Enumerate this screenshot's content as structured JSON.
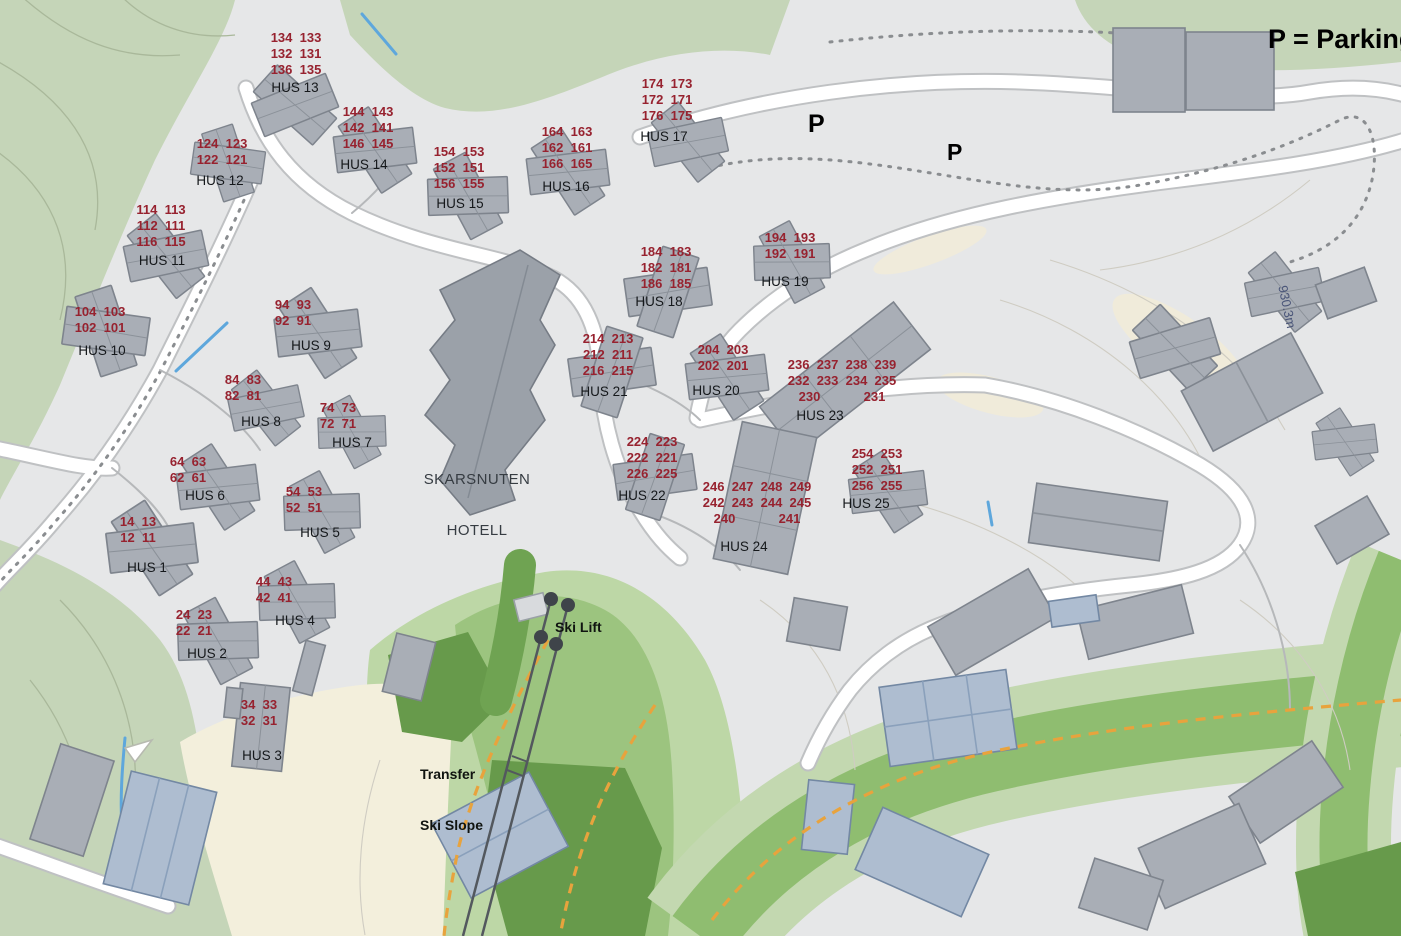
{
  "legend": {
    "parking_note": "P = Parking"
  },
  "map_labels": {
    "hotel_line1": "SKARSNUTEN",
    "hotel_line2": "HOTELL",
    "ski_lift": "Ski Lift",
    "transfer_line1": "Transfer",
    "transfer_line2": "Ski Slope",
    "p_label_1": "P",
    "p_label_2": "P",
    "elevation": "930.3m"
  },
  "houses": [
    {
      "label": "HUS 1",
      "x": 138,
      "y": 514,
      "lx": 147,
      "ly": 561,
      "rows": [
        "14  13",
        "12  11"
      ]
    },
    {
      "label": "HUS 2",
      "x": 194,
      "y": 607,
      "lx": 207,
      "ly": 647,
      "rows": [
        "24  23",
        "22  21"
      ]
    },
    {
      "label": "HUS 3",
      "x": 259,
      "y": 697,
      "lx": 262,
      "ly": 749,
      "rows": [
        "34  33",
        "32  31"
      ]
    },
    {
      "label": "HUS 4",
      "x": 274,
      "y": 574,
      "lx": 295,
      "ly": 614,
      "rows": [
        "44  43",
        "42  41"
      ]
    },
    {
      "label": "HUS 5",
      "x": 304,
      "y": 484,
      "lx": 320,
      "ly": 526,
      "rows": [
        "54  53",
        "52  51"
      ]
    },
    {
      "label": "HUS 6",
      "x": 188,
      "y": 454,
      "lx": 205,
      "ly": 489,
      "rows": [
        "64  63",
        "62  61"
      ]
    },
    {
      "label": "HUS 7",
      "x": 338,
      "y": 400,
      "lx": 352,
      "ly": 436,
      "rows": [
        "74  73",
        "72  71"
      ]
    },
    {
      "label": "HUS 8",
      "x": 243,
      "y": 372,
      "lx": 261,
      "ly": 415,
      "rows": [
        "84  83",
        "82  81"
      ]
    },
    {
      "label": "HUS 9",
      "x": 293,
      "y": 297,
      "lx": 311,
      "ly": 339,
      "rows": [
        "94  93",
        "92  91"
      ]
    },
    {
      "label": "HUS 10",
      "x": 100,
      "y": 304,
      "lx": 102,
      "ly": 344,
      "rows": [
        "104  103",
        "102  101"
      ]
    },
    {
      "label": "HUS 11",
      "x": 161,
      "y": 202,
      "lx": 162,
      "ly": 254,
      "rows": [
        "114  113",
        "112  111",
        "116  115"
      ]
    },
    {
      "label": "HUS 12",
      "x": 222,
      "y": 136,
      "lx": 220,
      "ly": 174,
      "rows": [
        "124  123",
        "122  121"
      ]
    },
    {
      "label": "HUS 13",
      "x": 296,
      "y": 30,
      "lx": 295,
      "ly": 81,
      "rows": [
        "134  133",
        "132  131",
        "136  135"
      ]
    },
    {
      "label": "HUS 14",
      "x": 368,
      "y": 104,
      "lx": 364,
      "ly": 158,
      "rows": [
        "144  143",
        "142  141",
        "146  145"
      ]
    },
    {
      "label": "HUS 15",
      "x": 459,
      "y": 144,
      "lx": 460,
      "ly": 197,
      "rows": [
        "154  153",
        "152  151",
        "156  155"
      ]
    },
    {
      "label": "HUS 16",
      "x": 567,
      "y": 124,
      "lx": 566,
      "ly": 180,
      "rows": [
        "164  163",
        "162  161",
        "166  165"
      ]
    },
    {
      "label": "HUS 17",
      "x": 667,
      "y": 76,
      "lx": 664,
      "ly": 130,
      "rows": [
        "174  173",
        "172  171",
        "176  175"
      ]
    },
    {
      "label": "HUS 18",
      "x": 666,
      "y": 244,
      "lx": 659,
      "ly": 295,
      "rows": [
        "184  183",
        "182  181",
        "186  185"
      ]
    },
    {
      "label": "HUS 19",
      "x": 790,
      "y": 230,
      "lx": 785,
      "ly": 275,
      "rows": [
        "194  193",
        "192  191"
      ]
    },
    {
      "label": "HUS 20",
      "x": 723,
      "y": 342,
      "lx": 716,
      "ly": 384,
      "rows": [
        "204  203",
        "202  201"
      ]
    },
    {
      "label": "HUS 21",
      "x": 608,
      "y": 331,
      "lx": 604,
      "ly": 385,
      "rows": [
        "214  213",
        "212  211",
        "216  215"
      ]
    },
    {
      "label": "HUS 22",
      "x": 652,
      "y": 434,
      "lx": 642,
      "ly": 489,
      "rows": [
        "224  223",
        "222  221",
        "226  225"
      ]
    },
    {
      "label": "HUS 23",
      "x": 842,
      "y": 357,
      "lx": 820,
      "ly": 409,
      "rows": [
        "236  237  238  239",
        "232  233  234  235",
        "230            231"
      ]
    },
    {
      "label": "HUS 24",
      "x": 757,
      "y": 479,
      "lx": 744,
      "ly": 540,
      "rows": [
        "246  247  248  249",
        "242  243  244  245",
        "240            241"
      ]
    },
    {
      "label": "HUS 25",
      "x": 877,
      "y": 446,
      "lx": 866,
      "ly": 497,
      "rows": [
        "254  253",
        "252  251",
        "256  255"
      ]
    }
  ],
  "colors": {
    "unit_number": "#97222f",
    "sage_green": "#c5d5b8",
    "light_green": "#c3d8b0",
    "medium_green": "#8fbd70",
    "dark_green": "#679a4b",
    "beige": "#f3efdc",
    "building": "#a9aeb6",
    "road": "#ffffff",
    "orange_dash": "#e8a33d"
  }
}
